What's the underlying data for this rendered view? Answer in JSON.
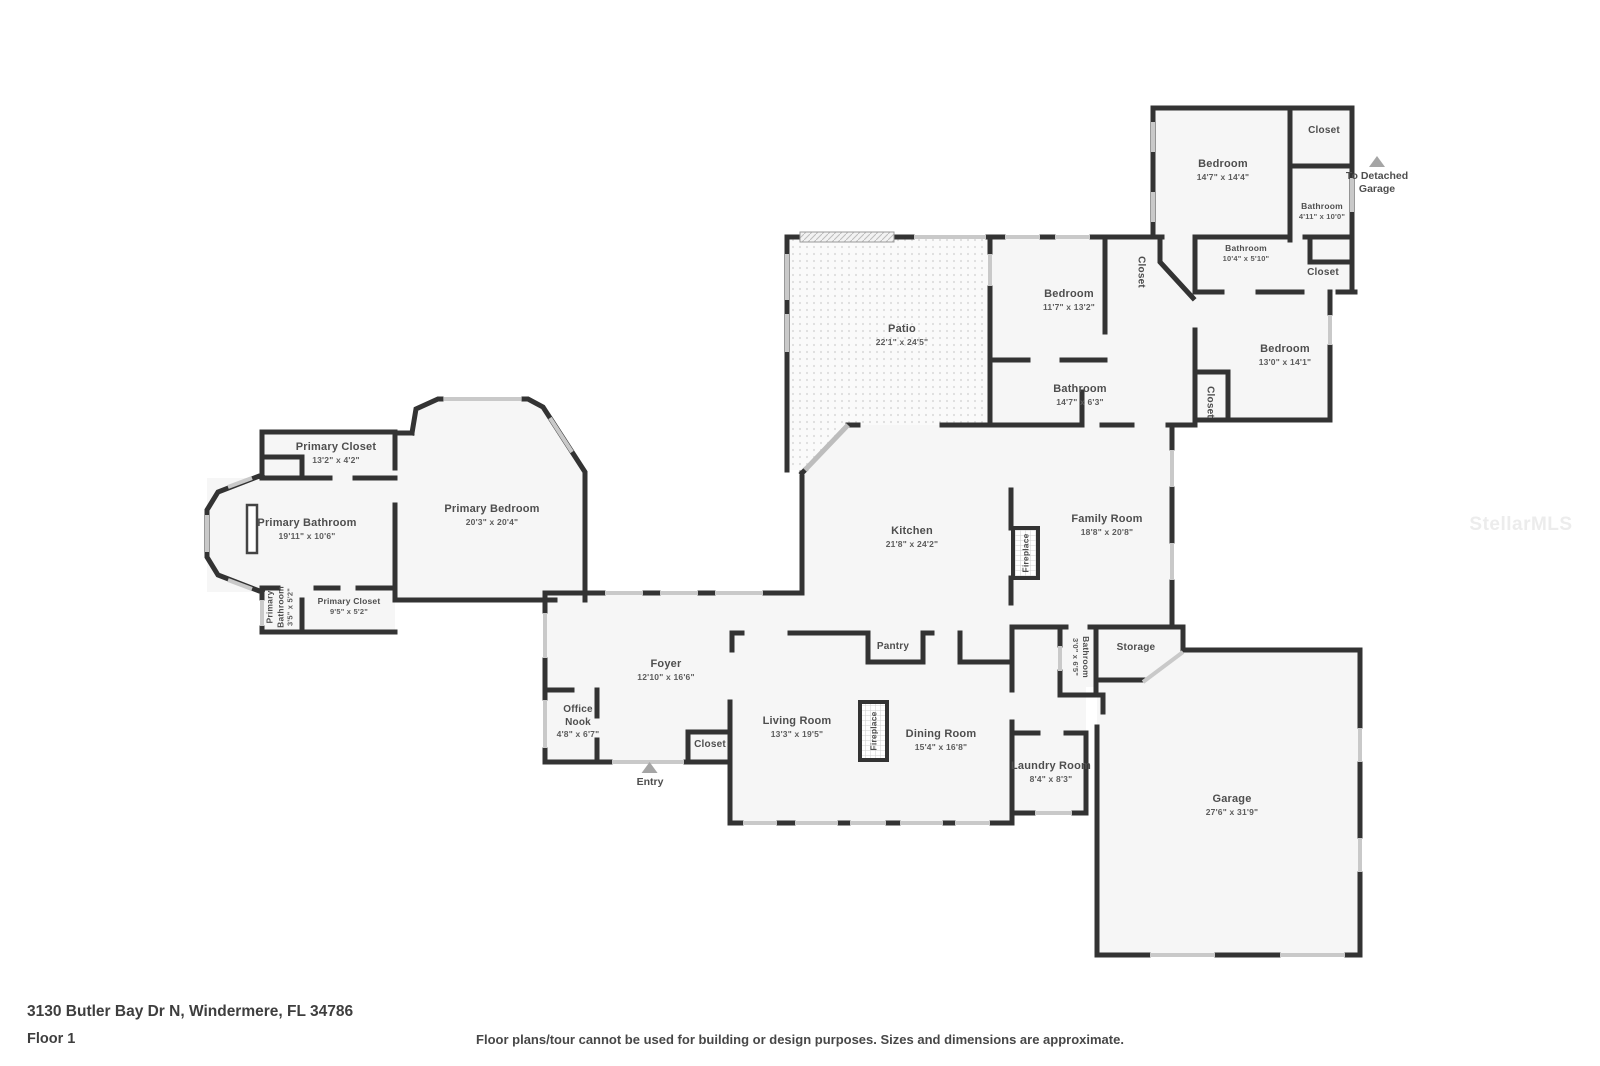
{
  "page": {
    "address": "3130 Butler Bay Dr N, Windermere, FL 34786",
    "floor_label": "Floor 1",
    "disclaimer": "Floor plans/tour cannot be used for building or design purposes. Sizes and dimensions are approximate.",
    "watermark": "StellarMLS"
  },
  "colors": {
    "wall": "#333333",
    "room_fill": "#f6f6f6",
    "window": "#c9c9c9",
    "label_text": "#4e4e4e",
    "marker": "#a5a5a5",
    "watermark": "#ececec"
  },
  "markers": [
    {
      "label": "To Detached Garage"
    },
    {
      "label": "Entry"
    }
  ],
  "rooms": [
    {
      "name": "Bedroom",
      "dims": "14'7\" x 14'4\""
    },
    {
      "name": "Closet",
      "dims": ""
    },
    {
      "name": "Bathroom",
      "dims": "4'11\" x 10'0\""
    },
    {
      "name": "Bathroom",
      "dims": "10'4\" x 5'10\""
    },
    {
      "name": "Closet",
      "dims": ""
    },
    {
      "name": "Closet",
      "dims": ""
    },
    {
      "name": "Bedroom",
      "dims": "13'0\" x 14'1\""
    },
    {
      "name": "Closet",
      "dims": ""
    },
    {
      "name": "Bedroom",
      "dims": "11'7\" x 13'2\""
    },
    {
      "name": "Bathroom",
      "dims": "14'7\" x 6'3\""
    },
    {
      "name": "Patio",
      "dims": "22'1\" x 24'5\""
    },
    {
      "name": "Primary Closet",
      "dims": "13'2\" x 4'2\""
    },
    {
      "name": "Primary Bathroom",
      "dims": "19'11\" x 10'6\""
    },
    {
      "name": "Primary Bedroom",
      "dims": "20'3\" x 20'4\""
    },
    {
      "name": "Primary Bathroom",
      "dims": "3'5\" x 5'2\""
    },
    {
      "name": "Primary Closet",
      "dims": "9'5\" x 5'2\""
    },
    {
      "name": "Kitchen",
      "dims": "21'8\" x 24'2\""
    },
    {
      "name": "Family Room",
      "dims": "18'8\" x 20'8\""
    },
    {
      "name": "Fireplace",
      "dims": ""
    },
    {
      "name": "Pantry",
      "dims": ""
    },
    {
      "name": "Foyer",
      "dims": "12'10\" x 16'6\""
    },
    {
      "name": "Office Nook",
      "dims": "4'8\" x 6'7\""
    },
    {
      "name": "Closet",
      "dims": ""
    },
    {
      "name": "Living Room",
      "dims": "13'3\" x 19'5\""
    },
    {
      "name": "Fireplace",
      "dims": ""
    },
    {
      "name": "Dining Room",
      "dims": "15'4\" x 16'8\""
    },
    {
      "name": "Bathroom",
      "dims": "3'0\" x 6'5\""
    },
    {
      "name": "Storage",
      "dims": ""
    },
    {
      "name": "Laundry Room",
      "dims": "8'4\" x 8'3\""
    },
    {
      "name": "Garage",
      "dims": "27'6\" x 31'9\""
    }
  ]
}
